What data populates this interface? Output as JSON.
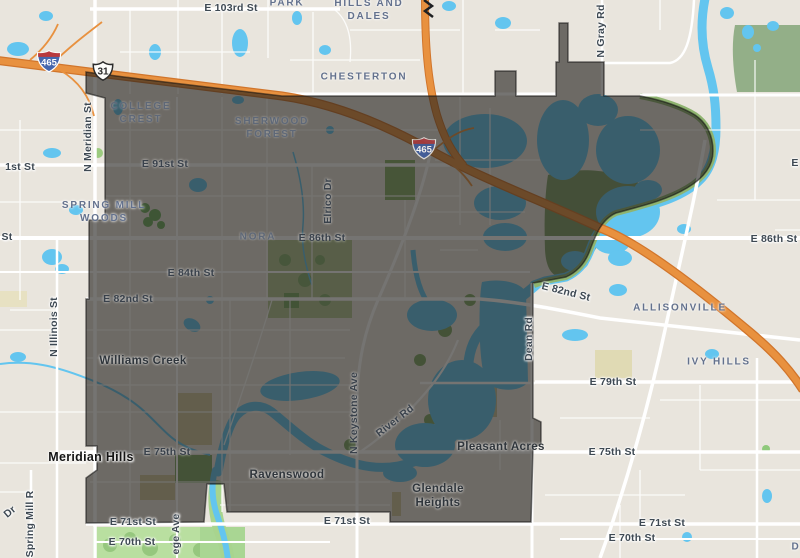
{
  "map": {
    "title": "Nora area map with highlighted district overlay",
    "colors": {
      "land": "#e9e5dd",
      "water": "#63c5ef",
      "park_bright": "#b9dfa0",
      "sage": "#93af88",
      "highway_orange": "#e8913f",
      "overlay_dark": "rgba(33,31,28,0.62)",
      "street_label": "#3e4953",
      "neighborhood_label": "#63718d"
    },
    "shields": [
      {
        "type": "interstate",
        "number": "465",
        "x": 49,
        "y": 61
      },
      {
        "type": "us-route",
        "number": "31",
        "x": 103,
        "y": 71
      },
      {
        "type": "interstate",
        "number": "465",
        "x": 424,
        "y": 148
      }
    ],
    "labels": [
      {
        "kind": "street",
        "lines": [
          "E 103rd St"
        ],
        "x": 231,
        "y": 8
      },
      {
        "kind": "street",
        "lines": [
          "1st St"
        ],
        "x": 20,
        "y": 167
      },
      {
        "kind": "street",
        "lines": [
          "E 91st St"
        ],
        "x": 165,
        "y": 164,
        "dim": true
      },
      {
        "kind": "street",
        "lines": [
          "St"
        ],
        "x": 7,
        "y": 237
      },
      {
        "kind": "street",
        "lines": [
          "E 86th St"
        ],
        "x": 322,
        "y": 238,
        "dim": true
      },
      {
        "kind": "street",
        "lines": [
          "E 86th St"
        ],
        "x": 774,
        "y": 239
      },
      {
        "kind": "street",
        "lines": [
          "E"
        ],
        "x": 795,
        "y": 163
      },
      {
        "kind": "street",
        "lines": [
          "E 84th St"
        ],
        "x": 191,
        "y": 273,
        "dim": true
      },
      {
        "kind": "street",
        "lines": [
          "E 82nd St"
        ],
        "x": 128,
        "y": 299,
        "dim": true
      },
      {
        "kind": "street",
        "lines": [
          "E 82nd St"
        ],
        "x": 566,
        "y": 292,
        "rotate": 14
      },
      {
        "kind": "street",
        "lines": [
          "E 79th St"
        ],
        "x": 613,
        "y": 382
      },
      {
        "kind": "street",
        "lines": [
          "E 75th St"
        ],
        "x": 167,
        "y": 452,
        "dim": true
      },
      {
        "kind": "street",
        "lines": [
          "E 75th St"
        ],
        "x": 612,
        "y": 452
      },
      {
        "kind": "street",
        "lines": [
          "E 71st St"
        ],
        "x": 133,
        "y": 522
      },
      {
        "kind": "street",
        "lines": [
          "E 71st St"
        ],
        "x": 347,
        "y": 521
      },
      {
        "kind": "street",
        "lines": [
          "E 71st St"
        ],
        "x": 662,
        "y": 523
      },
      {
        "kind": "street",
        "lines": [
          "E 70th St"
        ],
        "x": 132,
        "y": 542
      },
      {
        "kind": "street",
        "lines": [
          "E 70th St"
        ],
        "x": 632,
        "y": 538
      },
      {
        "kind": "street",
        "lines": [
          "N Meridian St"
        ],
        "x": 88,
        "y": 137,
        "rotate": -90
      },
      {
        "kind": "street",
        "lines": [
          "N Illinois St"
        ],
        "x": 54,
        "y": 327,
        "rotate": -90
      },
      {
        "kind": "street",
        "lines": [
          "Spring Mill R"
        ],
        "x": 30,
        "y": 524,
        "rotate": -90
      },
      {
        "kind": "street",
        "lines": [
          "ege Ave"
        ],
        "x": 176,
        "y": 534,
        "rotate": -90
      },
      {
        "kind": "street",
        "lines": [
          "N Keystone Ave"
        ],
        "x": 354,
        "y": 413,
        "rotate": -90,
        "dim": true
      },
      {
        "kind": "street",
        "lines": [
          "River Rd"
        ],
        "x": 395,
        "y": 421,
        "rotate": -38,
        "dim": true
      },
      {
        "kind": "street",
        "lines": [
          "Dean Rd"
        ],
        "x": 529,
        "y": 339,
        "rotate": -90
      },
      {
        "kind": "street",
        "lines": [
          "N Gray Rd"
        ],
        "x": 601,
        "y": 31,
        "rotate": -90
      },
      {
        "kind": "street",
        "lines": [
          "Elrico Dr"
        ],
        "x": 328,
        "y": 201,
        "rotate": -90,
        "dim": true
      },
      {
        "kind": "street",
        "lines": [
          "Dr"
        ],
        "x": 10,
        "y": 512,
        "rotate": -40
      },
      {
        "kind": "nbhd",
        "lines": [
          "PARK"
        ],
        "x": 287,
        "y": 3
      },
      {
        "kind": "nbhd",
        "lines": [
          "HILLS AND",
          "DALES"
        ],
        "x": 369,
        "y": 10
      },
      {
        "kind": "nbhd",
        "lines": [
          "CHESTERTON"
        ],
        "x": 364,
        "y": 77
      },
      {
        "kind": "nbhd",
        "lines": [
          "COLLEGE",
          "CREST"
        ],
        "x": 141,
        "y": 113,
        "dim": true
      },
      {
        "kind": "nbhd",
        "lines": [
          "SHERWOOD",
          "FOREST"
        ],
        "x": 272,
        "y": 128,
        "dim": true
      },
      {
        "kind": "nbhd",
        "lines": [
          "SPRING MILL",
          "WOODS"
        ],
        "x": 104,
        "y": 212
      },
      {
        "kind": "nbhd",
        "lines": [
          "NORA"
        ],
        "x": 258,
        "y": 237,
        "dim": true
      },
      {
        "kind": "nbhd",
        "lines": [
          "ALLISONVILLE"
        ],
        "x": 680,
        "y": 308
      },
      {
        "kind": "nbhd",
        "lines": [
          "IVY HILLS"
        ],
        "x": 719,
        "y": 362
      },
      {
        "kind": "nbhd",
        "lines": [
          "D"
        ],
        "x": 796,
        "y": 547
      },
      {
        "kind": "place",
        "lines": [
          "Williams Creek"
        ],
        "x": 143,
        "y": 361,
        "dim": true
      },
      {
        "kind": "place",
        "lines": [
          "Ravenswood"
        ],
        "x": 287,
        "y": 475,
        "dim": true
      },
      {
        "kind": "place",
        "lines": [
          "Pleasant Acres"
        ],
        "x": 501,
        "y": 447,
        "dim": true
      },
      {
        "kind": "place",
        "lines": [
          "Glendale",
          "Heights"
        ],
        "x": 438,
        "y": 496,
        "dim": true
      },
      {
        "kind": "city",
        "lines": [
          "Meridian Hills"
        ],
        "x": 91,
        "y": 457
      }
    ]
  }
}
